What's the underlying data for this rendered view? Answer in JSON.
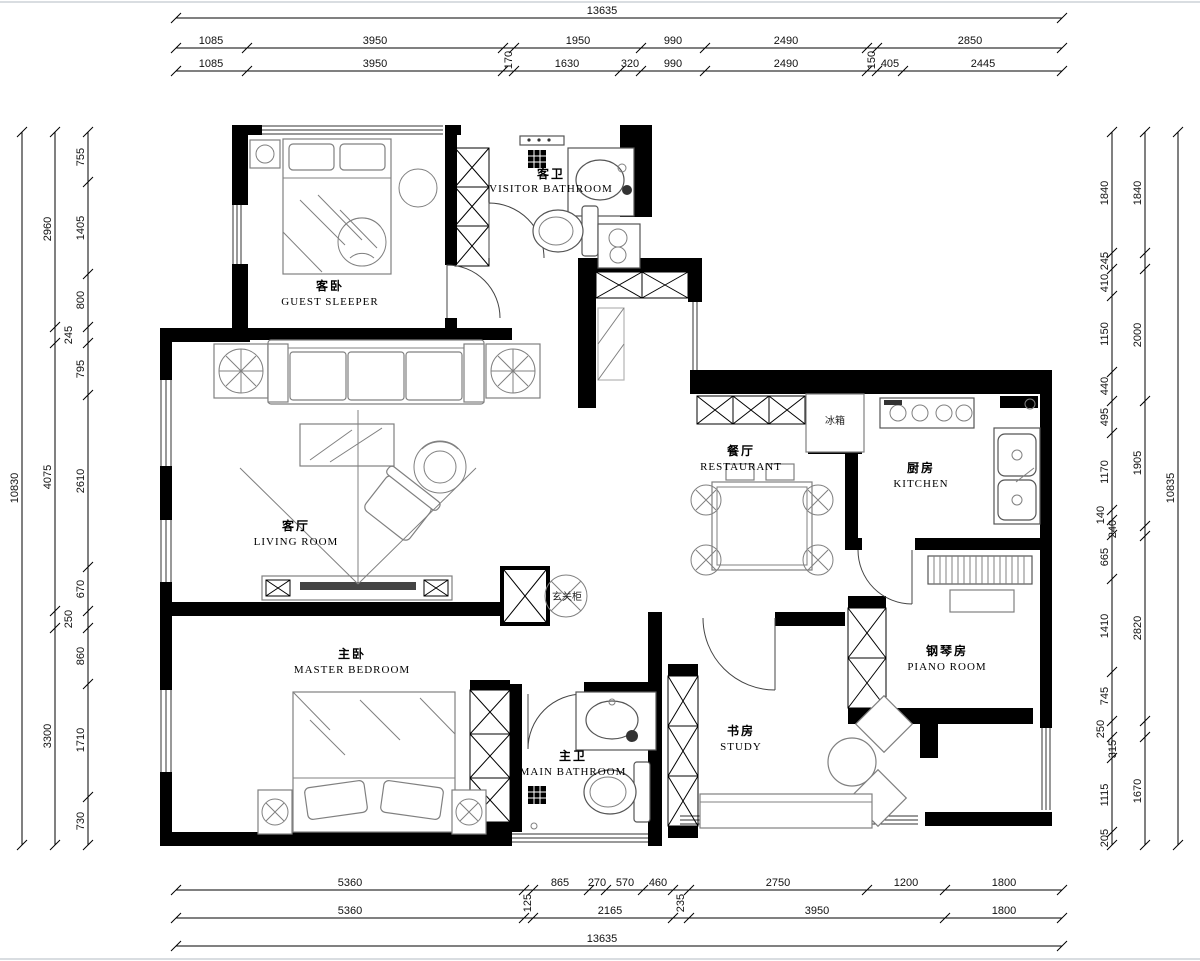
{
  "meta": {
    "drawing_type": "residential floor plan"
  },
  "colors": {
    "wall": "#000000",
    "furniture": "#808080",
    "dimension_text": "#111111",
    "background": "#ffffff"
  },
  "rooms": {
    "guest": {
      "zh": "客卧",
      "en": "GUEST SLEEPER"
    },
    "visitor_bath": {
      "zh": "客卫",
      "en": "VISITOR BATHROOM"
    },
    "living": {
      "zh": "客厅",
      "en": "LIVING ROOM"
    },
    "restaurant": {
      "zh": "餐厅",
      "en": "RESTAURANT"
    },
    "kitchen": {
      "zh": "厨房",
      "en": "KITCHEN"
    },
    "master": {
      "zh": "主卧",
      "en": "MASTER BEDROOM"
    },
    "main_bath": {
      "zh": "主卫",
      "en": "MAIN BATHROOM"
    },
    "study": {
      "zh": "书房",
      "en": "STUDY"
    },
    "piano": {
      "zh": "钢琴房",
      "en": "PIANO ROOM"
    },
    "fridge": {
      "zh": "冰箱"
    },
    "entry_cabinet": {
      "zh": "玄关柜"
    }
  },
  "dimensions": {
    "overall": {
      "top": "13635",
      "bottom": "13635",
      "left": "10830",
      "right": "10835"
    },
    "top_coarse": [
      "1085",
      "3950",
      "170",
      "1950",
      "990",
      "2490",
      "150",
      "2850"
    ],
    "top_fine": [
      "1085",
      "3950",
      "170",
      "1630",
      "320",
      "990",
      "2490",
      "150",
      "405",
      "2445"
    ],
    "bottom_fine": [
      "5360",
      "125",
      "865",
      "270",
      "570",
      "460",
      "235",
      "2750",
      "1200",
      "1800"
    ],
    "bottom_coarse": [
      "5360",
      "125",
      "2165",
      "235",
      "3950",
      "1800"
    ],
    "left_coarse": [
      "2960",
      "245",
      "4075",
      "250",
      "3300"
    ],
    "left_fine": [
      "755",
      "1405",
      "800",
      "245",
      "795",
      "2610",
      "670",
      "250",
      "860",
      "1710",
      "730"
    ],
    "right_fine": [
      "1840",
      "245",
      "410",
      "1150",
      "440",
      "495",
      "1170",
      "140",
      "240",
      "665",
      "1410",
      "745",
      "250",
      "315",
      "1115",
      "205"
    ],
    "right_coarse": [
      "1840",
      "2000",
      "1905",
      "2820",
      "1670"
    ],
    "chains": [
      {
        "o": "h",
        "y": 18,
        "a": 176,
        "b": 1062,
        "ticks": [
          176,
          1062
        ]
      },
      {
        "o": "h",
        "y": 48,
        "a": 176,
        "b": 1062,
        "ticks": [
          176,
          247,
          503,
          514,
          641,
          705,
          867,
          877,
          1062
        ]
      },
      {
        "o": "h",
        "y": 71,
        "a": 176,
        "b": 1062,
        "ticks": [
          176,
          247,
          503,
          514,
          620,
          641,
          705,
          867,
          877,
          903,
          1062
        ]
      },
      {
        "o": "h",
        "y": 890,
        "a": 176,
        "b": 1062,
        "ticks": [
          176,
          524,
          533,
          589,
          606,
          643,
          673,
          689,
          867,
          945,
          1062
        ]
      },
      {
        "o": "h",
        "y": 918,
        "a": 176,
        "b": 1062,
        "ticks": [
          176,
          524,
          533,
          673,
          689,
          945,
          1062
        ]
      },
      {
        "o": "h",
        "y": 946,
        "a": 176,
        "b": 1062,
        "ticks": [
          176,
          1062
        ]
      },
      {
        "o": "v",
        "x": 22,
        "a": 132,
        "b": 845,
        "ticks": [
          132,
          845
        ]
      },
      {
        "o": "v",
        "x": 55,
        "a": 132,
        "b": 845,
        "ticks": [
          132,
          327,
          343,
          611,
          628,
          845
        ]
      },
      {
        "o": "v",
        "x": 88,
        "a": 132,
        "b": 845,
        "ticks": [
          132,
          182,
          274,
          327,
          343,
          395,
          567,
          611,
          628,
          684,
          797,
          845
        ]
      },
      {
        "o": "v",
        "x": 1112,
        "a": 132,
        "b": 845,
        "ticks": [
          132,
          253,
          269,
          296,
          372,
          401,
          433,
          510,
          520,
          535,
          579,
          672,
          721,
          737,
          758,
          832,
          845
        ]
      },
      {
        "o": "v",
        "x": 1145,
        "a": 132,
        "b": 845,
        "ticks": [
          132,
          253,
          269,
          401,
          526,
          536,
          721,
          737,
          845
        ]
      },
      {
        "o": "v",
        "x": 1178,
        "a": 132,
        "b": 845,
        "ticks": [
          132,
          845
        ]
      }
    ],
    "labels": [
      {
        "t": "13635",
        "x": 602,
        "y": 14
      },
      {
        "t": "1085",
        "x": 211,
        "y": 44
      },
      {
        "t": "3950",
        "x": 375,
        "y": 44
      },
      {
        "t": "1950",
        "x": 578,
        "y": 44
      },
      {
        "t": "990",
        "x": 673,
        "y": 44
      },
      {
        "t": "2490",
        "x": 786,
        "y": 44
      },
      {
        "t": "2850",
        "x": 970,
        "y": 44
      },
      {
        "t": "170",
        "x": 512,
        "y": 60,
        "r": 1
      },
      {
        "t": "150",
        "x": 875,
        "y": 60,
        "r": 1
      },
      {
        "t": "1085",
        "x": 211,
        "y": 67
      },
      {
        "t": "3950",
        "x": 375,
        "y": 67
      },
      {
        "t": "1630",
        "x": 567,
        "y": 67
      },
      {
        "t": "320",
        "x": 630,
        "y": 67
      },
      {
        "t": "990",
        "x": 673,
        "y": 67
      },
      {
        "t": "2490",
        "x": 786,
        "y": 67
      },
      {
        "t": "405",
        "x": 890,
        "y": 67
      },
      {
        "t": "2445",
        "x": 983,
        "y": 67
      },
      {
        "t": "5360",
        "x": 350,
        "y": 886
      },
      {
        "t": "865",
        "x": 560,
        "y": 886
      },
      {
        "t": "270",
        "x": 597,
        "y": 886
      },
      {
        "t": "570",
        "x": 625,
        "y": 886
      },
      {
        "t": "460",
        "x": 658,
        "y": 886
      },
      {
        "t": "2750",
        "x": 778,
        "y": 886
      },
      {
        "t": "1200",
        "x": 906,
        "y": 886
      },
      {
        "t": "1800",
        "x": 1004,
        "y": 886
      },
      {
        "t": "125",
        "x": 531,
        "y": 903,
        "r": 1
      },
      {
        "t": "235",
        "x": 684,
        "y": 903,
        "r": 1
      },
      {
        "t": "5360",
        "x": 350,
        "y": 914
      },
      {
        "t": "2165",
        "x": 610,
        "y": 914
      },
      {
        "t": "3950",
        "x": 817,
        "y": 914
      },
      {
        "t": "1800",
        "x": 1004,
        "y": 914
      },
      {
        "t": "13635",
        "x": 602,
        "y": 942
      },
      {
        "t": "755",
        "x": 84,
        "y": 157,
        "r": 1
      },
      {
        "t": "1405",
        "x": 84,
        "y": 228,
        "r": 1
      },
      {
        "t": "800",
        "x": 84,
        "y": 300,
        "r": 1
      },
      {
        "t": "795",
        "x": 84,
        "y": 369,
        "r": 1
      },
      {
        "t": "2610",
        "x": 84,
        "y": 481,
        "r": 1
      },
      {
        "t": "670",
        "x": 84,
        "y": 589,
        "r": 1
      },
      {
        "t": "860",
        "x": 84,
        "y": 656,
        "r": 1
      },
      {
        "t": "1710",
        "x": 84,
        "y": 740,
        "r": 1
      },
      {
        "t": "730",
        "x": 84,
        "y": 821,
        "r": 1
      },
      {
        "t": "245",
        "x": 72,
        "y": 335,
        "r": 1
      },
      {
        "t": "250",
        "x": 72,
        "y": 619,
        "r": 1
      },
      {
        "t": "2960",
        "x": 51,
        "y": 229,
        "r": 1
      },
      {
        "t": "4075",
        "x": 51,
        "y": 477,
        "r": 1
      },
      {
        "t": "3300",
        "x": 51,
        "y": 736,
        "r": 1
      },
      {
        "t": "10830",
        "x": 18,
        "y": 488,
        "r": 1
      },
      {
        "t": "1840",
        "x": 1108,
        "y": 193,
        "r": 1
      },
      {
        "t": "245",
        "x": 1108,
        "y": 261,
        "r": 1
      },
      {
        "t": "410",
        "x": 1108,
        "y": 283,
        "r": 1
      },
      {
        "t": "1150",
        "x": 1108,
        "y": 334,
        "r": 1
      },
      {
        "t": "440",
        "x": 1108,
        "y": 386,
        "r": 1
      },
      {
        "t": "495",
        "x": 1108,
        "y": 417,
        "r": 1
      },
      {
        "t": "1170",
        "x": 1108,
        "y": 472,
        "r": 1
      },
      {
        "t": "140",
        "x": 1104,
        "y": 515,
        "r": 1
      },
      {
        "t": "240",
        "x": 1116,
        "y": 529,
        "r": 1
      },
      {
        "t": "665",
        "x": 1108,
        "y": 557,
        "r": 1
      },
      {
        "t": "1410",
        "x": 1108,
        "y": 626,
        "r": 1
      },
      {
        "t": "745",
        "x": 1108,
        "y": 696,
        "r": 1
      },
      {
        "t": "250",
        "x": 1104,
        "y": 729,
        "r": 1
      },
      {
        "t": "315",
        "x": 1116,
        "y": 749,
        "r": 1
      },
      {
        "t": "1115",
        "x": 1108,
        "y": 795,
        "r": 1
      },
      {
        "t": "205",
        "x": 1108,
        "y": 838,
        "r": 1
      },
      {
        "t": "1840",
        "x": 1141,
        "y": 193,
        "r": 1
      },
      {
        "t": "2000",
        "x": 1141,
        "y": 335,
        "r": 1
      },
      {
        "t": "1905",
        "x": 1141,
        "y": 463,
        "r": 1
      },
      {
        "t": "2820",
        "x": 1141,
        "y": 628,
        "r": 1
      },
      {
        "t": "1670",
        "x": 1141,
        "y": 791,
        "r": 1
      },
      {
        "t": "10835",
        "x": 1174,
        "y": 488,
        "r": 1
      }
    ]
  }
}
